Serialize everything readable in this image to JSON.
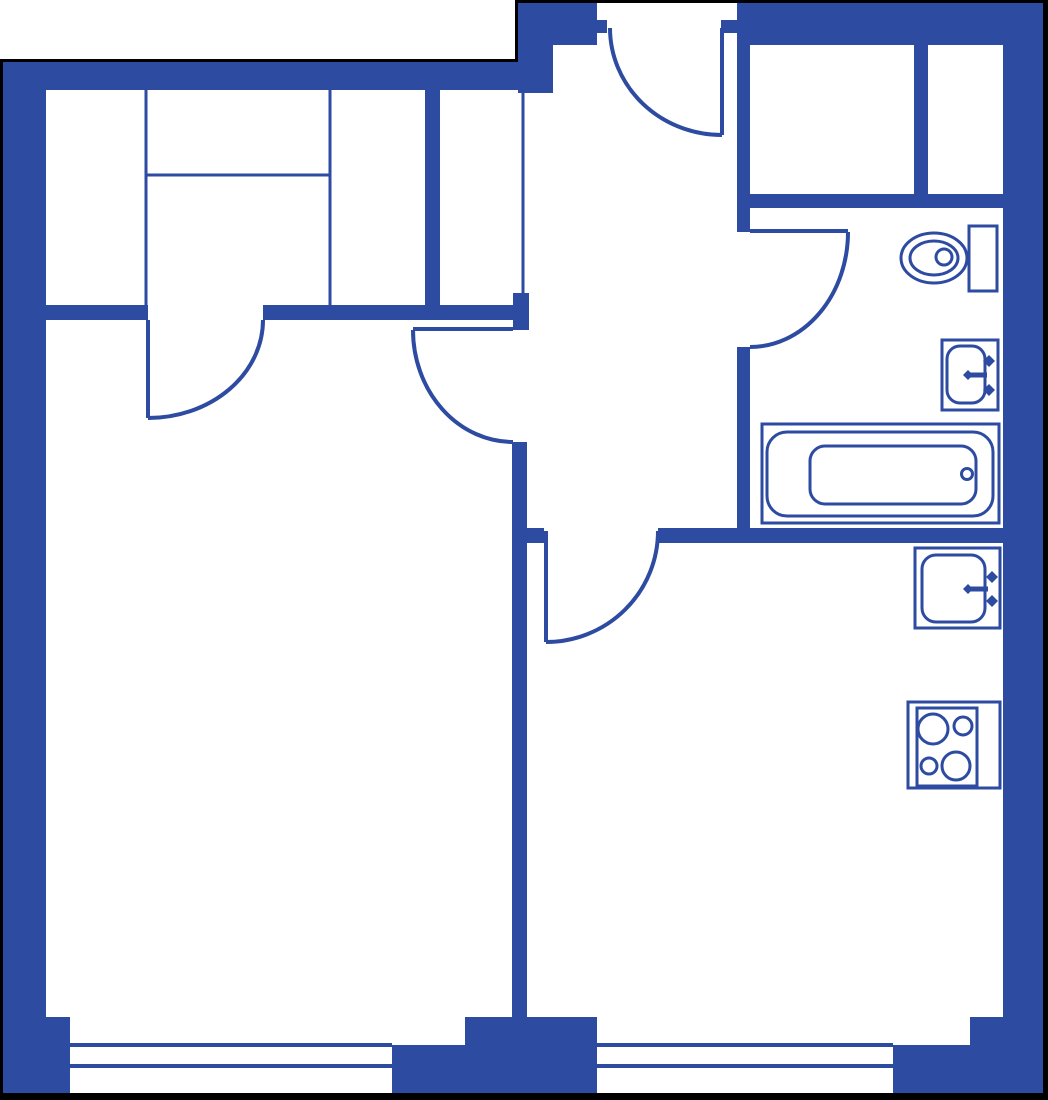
{
  "canvas": {
    "width": 1048,
    "height": 1100,
    "background": "#ffffff"
  },
  "colors": {
    "wall": "#2d4ba0",
    "line": "#2d4ba0",
    "outline": "#000000",
    "floor": "#ffffff"
  },
  "stroke": {
    "partition": 3,
    "window": 4,
    "door_leaf": 4,
    "door_arc": 4,
    "fixture": 3
  },
  "outline_segments": [
    {
      "name": "outline-top-left",
      "rect": [
        0,
        59,
        518,
        4
      ]
    },
    {
      "name": "outline-step",
      "rect": [
        515,
        0,
        3,
        62
      ]
    },
    {
      "name": "outline-top-right",
      "rect": [
        515,
        0,
        533,
        3
      ]
    },
    {
      "name": "outline-right",
      "rect": [
        1043,
        0,
        5,
        1100
      ]
    },
    {
      "name": "outline-bottom",
      "rect": [
        0,
        1093,
        1048,
        7
      ]
    },
    {
      "name": "outline-left",
      "rect": [
        0,
        59,
        3,
        1041
      ]
    }
  ],
  "walls": [
    {
      "name": "left-exterior-wall",
      "rect": [
        3,
        62,
        43,
        955
      ]
    },
    {
      "name": "top-left-exterior-wall",
      "rect": [
        3,
        62,
        550,
        28
      ]
    },
    {
      "name": "entry-step-pier",
      "rect": [
        518,
        3,
        35,
        90
      ]
    },
    {
      "name": "top-wall-left-of-entrance",
      "rect": [
        553,
        3,
        44,
        42
      ]
    },
    {
      "name": "entrance-left-jamb",
      "rect": [
        597,
        20,
        10,
        13
      ]
    },
    {
      "name": "entrance-right-jamb",
      "rect": [
        721,
        20,
        16,
        13
      ]
    },
    {
      "name": "top-right-exterior-wall",
      "rect": [
        737,
        3,
        306,
        42
      ]
    },
    {
      "name": "right-exterior-wall",
      "rect": [
        1003,
        3,
        40,
        1014
      ]
    },
    {
      "name": "closet-divider-wall",
      "rect": [
        914,
        45,
        14,
        149
      ]
    },
    {
      "name": "hall-bathroom-wall-upper",
      "rect": [
        737,
        45,
        13,
        187
      ]
    },
    {
      "name": "hall-bathroom-wall-lower",
      "rect": [
        737,
        347,
        13,
        196
      ]
    },
    {
      "name": "closet-bottom-wall",
      "rect": [
        737,
        194,
        266,
        14
      ]
    },
    {
      "name": "kitchen-bathroom-wall",
      "rect": [
        658,
        528,
        347,
        15
      ]
    },
    {
      "name": "kitchen-door-stub-wall",
      "rect": [
        512,
        528,
        32,
        15
      ]
    },
    {
      "name": "living-kitchen-wall",
      "rect": [
        512,
        442,
        15,
        575
      ]
    },
    {
      "name": "bedroom-right-wall",
      "rect": [
        425,
        90,
        15,
        215
      ]
    },
    {
      "name": "bedroom-living-wall-left",
      "rect": [
        46,
        305,
        102,
        15
      ]
    },
    {
      "name": "bedroom-living-wall-right",
      "rect": [
        263,
        305,
        250,
        15
      ]
    },
    {
      "name": "hall-door-jamb-block",
      "rect": [
        513,
        293,
        16,
        37
      ]
    },
    {
      "name": "bottom-left-pier",
      "rect": [
        3,
        1017,
        67,
        76
      ]
    },
    {
      "name": "bottom-center-pier-upper",
      "rect": [
        465,
        1017,
        132,
        28
      ]
    },
    {
      "name": "bottom-center-pier-lower",
      "rect": [
        392,
        1045,
        205,
        48
      ]
    },
    {
      "name": "bottom-right-pier-upper",
      "rect": [
        970,
        1017,
        73,
        28
      ]
    },
    {
      "name": "bottom-right-pier-lower",
      "rect": [
        893,
        1045,
        150,
        48
      ]
    }
  ],
  "partitions": [
    {
      "name": "wardrobe-side-panel-left",
      "line": [
        146,
        90,
        146,
        305
      ]
    },
    {
      "name": "wardrobe-side-panel-right",
      "line": [
        330,
        90,
        330,
        305
      ]
    },
    {
      "name": "wardrobe-shelf-line",
      "line": [
        146,
        175,
        330,
        175
      ]
    },
    {
      "name": "hall-closet-front-line",
      "line": [
        523,
        90,
        523,
        293
      ]
    }
  ],
  "windows": [
    {
      "name": "living-room-window",
      "lines": [
        [
          70,
          1045,
          392,
          1045
        ],
        [
          70,
          1066,
          392,
          1066
        ]
      ]
    },
    {
      "name": "kitchen-window",
      "lines": [
        [
          597,
          1045,
          893,
          1045
        ],
        [
          597,
          1066,
          893,
          1066
        ]
      ]
    }
  ],
  "doors": [
    {
      "name": "entrance-door",
      "leaf": [
        722,
        28,
        722,
        135
      ],
      "arc": "M 610 28 A 112 107 0 0 0 722 135"
    },
    {
      "name": "bedroom-door",
      "leaf": [
        148,
        320,
        148,
        418
      ],
      "arc": "M 148 418 A 115 98 0 0 0 263 320"
    },
    {
      "name": "living-room-door",
      "leaf": [
        413,
        329,
        513,
        329
      ],
      "arc": "M 413 330 A 100 112 0 0 0 513 442"
    },
    {
      "name": "kitchen-door",
      "leaf": [
        546,
        531,
        546,
        642
      ],
      "arc": "M 546 642 A 112 111 0 0 0 658 531"
    },
    {
      "name": "bathroom-door",
      "leaf": [
        750,
        231,
        848,
        231
      ],
      "arc": "M 848 232 A 98 115 0 0 1 750 347"
    }
  ],
  "fixtures": [
    {
      "name": "toilet",
      "shapes": [
        {
          "type": "ellipse",
          "c": [
            934,
            258
          ],
          "r2": [
            33,
            25
          ]
        },
        {
          "type": "ellipse",
          "c": [
            934,
            258
          ],
          "r2": [
            24,
            17
          ]
        },
        {
          "type": "rect",
          "r": [
            969,
            226,
            28,
            65
          ],
          "fill": "#ffffff"
        },
        {
          "type": "circle",
          "c": [
            944,
            257
          ],
          "radius": 8
        }
      ]
    },
    {
      "name": "bathroom-sink",
      "shapes": [
        {
          "type": "rect",
          "r": [
            942,
            340,
            56,
            70
          ]
        },
        {
          "type": "rect",
          "r": [
            947,
            346,
            38,
            57
          ],
          "rx": 13
        },
        {
          "type": "line",
          "line": [
            967,
            375,
            987,
            375
          ],
          "sw": 5
        },
        {
          "type": "diamond",
          "c": [
            968,
            375
          ],
          "s": 5
        },
        {
          "type": "diamond",
          "c": [
            989,
            361
          ],
          "s": 6
        },
        {
          "type": "diamond",
          "c": [
            989,
            390
          ],
          "s": 6
        }
      ]
    },
    {
      "name": "bathtub",
      "shapes": [
        {
          "type": "rect",
          "r": [
            762,
            424,
            237,
            99
          ]
        },
        {
          "type": "rect",
          "r": [
            767,
            432,
            226,
            84
          ],
          "rx": 20
        },
        {
          "type": "rect",
          "r": [
            810,
            446,
            166,
            58
          ],
          "rx": 15
        },
        {
          "type": "circle",
          "c": [
            967,
            474
          ],
          "radius": 5.5
        }
      ]
    },
    {
      "name": "kitchen-sink",
      "shapes": [
        {
          "type": "rect",
          "r": [
            915,
            548,
            85,
            80
          ]
        },
        {
          "type": "rect",
          "r": [
            922,
            555,
            63,
            67
          ],
          "rx": 14
        },
        {
          "type": "line",
          "line": [
            967,
            589,
            988,
            589
          ],
          "sw": 5
        },
        {
          "type": "diamond",
          "c": [
            968,
            589
          ],
          "s": 5
        },
        {
          "type": "diamond",
          "c": [
            992,
            577
          ],
          "s": 6
        },
        {
          "type": "diamond",
          "c": [
            992,
            601
          ],
          "s": 6
        }
      ]
    },
    {
      "name": "stove",
      "shapes": [
        {
          "type": "rect",
          "r": [
            908,
            702,
            92,
            86
          ]
        },
        {
          "type": "rect",
          "r": [
            917,
            708,
            60,
            78
          ]
        },
        {
          "type": "circle",
          "c": [
            933,
            729
          ],
          "radius": 15
        },
        {
          "type": "circle",
          "c": [
            963,
            726
          ],
          "radius": 9
        },
        {
          "type": "circle",
          "c": [
            929,
            766
          ],
          "radius": 8
        },
        {
          "type": "circle",
          "c": [
            956,
            766
          ],
          "radius": 14
        }
      ]
    }
  ]
}
